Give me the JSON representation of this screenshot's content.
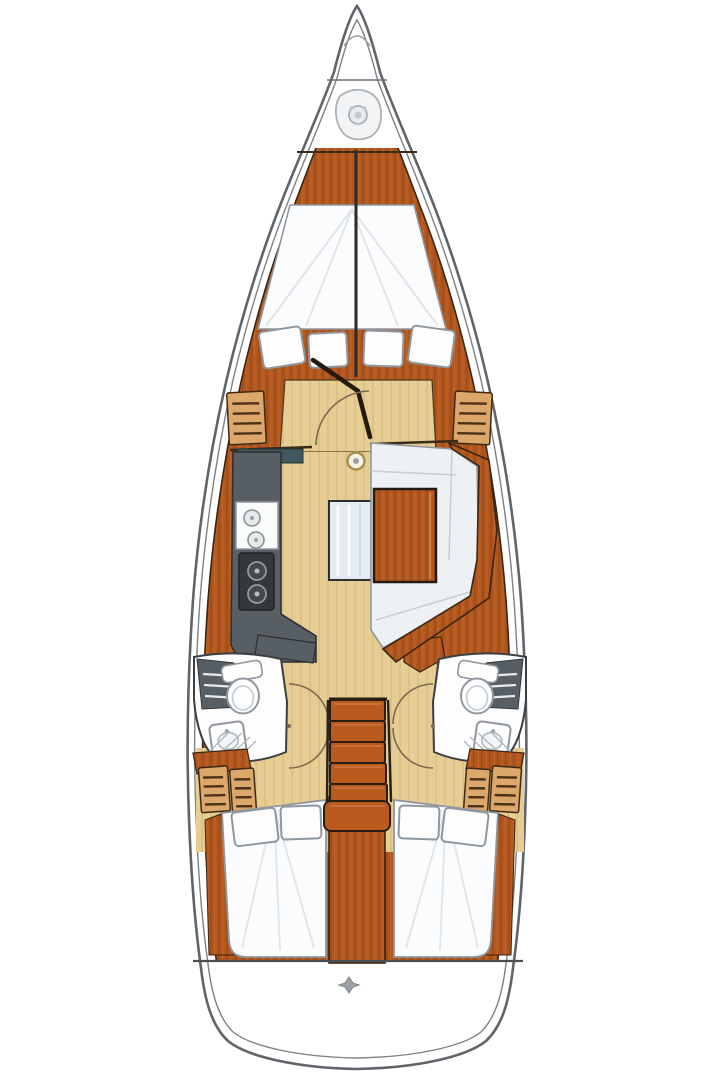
{
  "diagram": {
    "kind": "sailboat-interior-floor-plan",
    "orientation": "bow-up"
  },
  "colors": {
    "hull_line": "#5f656a",
    "inner_line": "#7b8186",
    "wood": "#b3571e",
    "wood_grain": "#7e3a10",
    "wood_outline": "#3a2512",
    "floor_tan": "#e6cd94",
    "floor_grain": "#c29c4f",
    "locker_tan": "#dca76a",
    "locker_stripe": "#4a3115",
    "galley_gray": "#585f64",
    "galley_teal": "#40585d",
    "stove_dark": "#33383c",
    "step_orange": "#bb5a1f",
    "cushion_white": "#eef1f4",
    "cushion_seam": "#c6ced4",
    "bench_blue": "#e4ebf1",
    "berth_white": "#fbfcfd",
    "room_white": "#fdfdfe",
    "fixture_line": "#8f979e",
    "counter_stripe": "#e8eaec",
    "arc_brown": "#7a6a4e",
    "seam_dark": "#2e2a24",
    "metal_gray": "#9aa0a5"
  },
  "icons": {
    "bow": "anchor-windlass-icon",
    "salon": "mast-step-icon",
    "transom": "stern-fitting-icon"
  }
}
